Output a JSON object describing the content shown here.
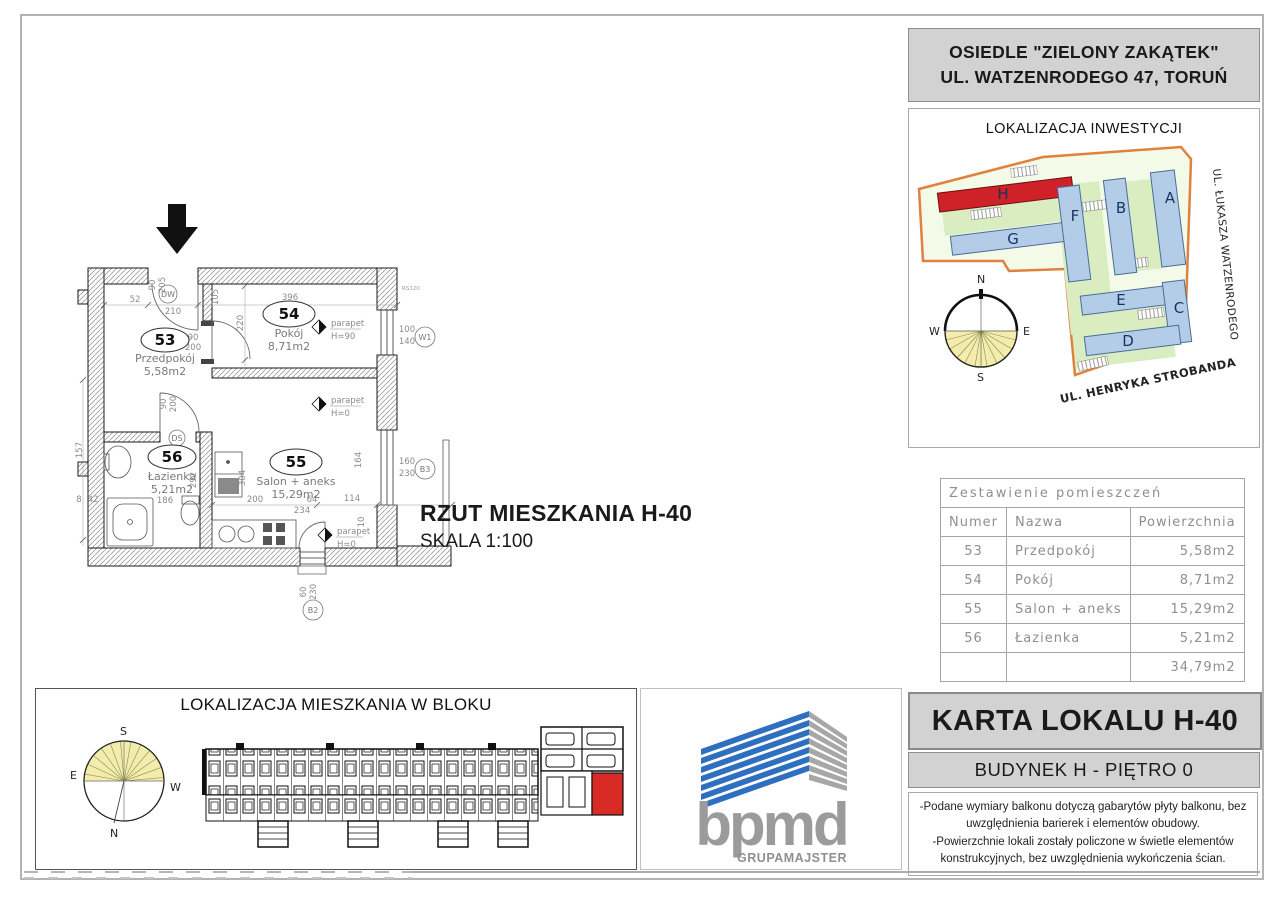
{
  "header": {
    "line1": "OSIEDLE \"ZIELONY ZAKĄTEK\"",
    "line2": "UL. WATZENRODEGO 47, TORUŃ"
  },
  "invest": {
    "title": "LOKALIZACJA INWESTYCJI",
    "street_right": "UL. ŁUKASZA WATZENRODEGO",
    "street_bottom": "UL. HENRYKA STROBANDA",
    "buildings": [
      "H",
      "G",
      "F",
      "B",
      "A",
      "E",
      "C",
      "D"
    ],
    "compass": {
      "n": "N",
      "s": "S",
      "e": "E",
      "w": "W"
    }
  },
  "plan": {
    "title": "RZUT MIESZKANIA  H-40",
    "scale": "SKALA 1:100",
    "rooms": [
      {
        "number": "53",
        "name": "Przedpokój",
        "area": "5,58m2"
      },
      {
        "number": "54",
        "name": "Pokój",
        "area": "8,71m2"
      },
      {
        "number": "55",
        "name": "Salon + aneks",
        "area": "15,29m2"
      },
      {
        "number": "56",
        "name": "Łazienka",
        "area": "5,21m2"
      }
    ],
    "markers": {
      "w1": "W1",
      "b3": "B3",
      "b2": "B2",
      "dw": "DW",
      "ds": "DS",
      "rs120": "RS120"
    },
    "parapet_label": "parapet",
    "parapet_w1": "H=90",
    "parapet_b3": "H=0",
    "parapet_b2": "H=0",
    "dims": [
      "52",
      "210",
      "105",
      "220",
      "396",
      "90",
      "200",
      "90",
      "205",
      "100",
      "140",
      "160",
      "230",
      "60",
      "230",
      "157",
      "186",
      "292",
      "304",
      "200",
      "64",
      "234",
      "114",
      "164",
      "10",
      "90",
      "200",
      "8",
      "42"
    ]
  },
  "table": {
    "title": "Zestawienie pomieszczeń",
    "headers": [
      "Numer",
      "Nazwa",
      "Powierzchnia"
    ],
    "rows": [
      [
        "53",
        "Przedpokój",
        "5,58m2"
      ],
      [
        "54",
        "Pokój",
        "8,71m2"
      ],
      [
        "55",
        "Salon + aneks",
        "15,29m2"
      ],
      [
        "56",
        "Łazienka",
        "5,21m2"
      ]
    ],
    "total": "34,79m2"
  },
  "karta": {
    "title": "KARTA LOKALU H-40",
    "subtitle": "BUDYNEK H - PIĘTRO 0",
    "notes": [
      "-Podane wymiary balkonu dotyczą gabarytów płyty balkonu, bez uwzględnienia barierek i elementów obudowy.",
      "-Powierzchnie lokali zostały policzone w świetle elementów konstrukcyjnych, bez uwzględnienia wykończenia ścian."
    ]
  },
  "block": {
    "title": "LOKALIZACJA MIESZKANIA W BLOKU",
    "compass": {
      "n": "N",
      "s": "S",
      "e": "E",
      "w": "W"
    }
  },
  "logo": {
    "name": "bpmd",
    "sub": "GRUPAMAJSTER"
  },
  "colors": {
    "highlight_red": "#d92b26",
    "building_blue": "#b3cde8",
    "accent_orange": "#e0813e",
    "logo_blue": "#2e6fc0",
    "panel_gray": "#d2d2d2"
  }
}
